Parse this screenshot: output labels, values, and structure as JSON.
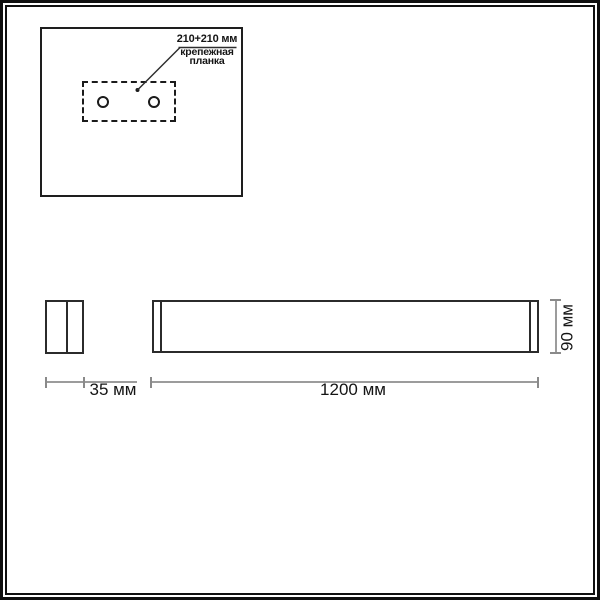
{
  "drawing": {
    "annotation": {
      "dimension_text": "210+210 мм",
      "label_line1": "крепежная",
      "label_line2": "планка"
    },
    "dimensions": {
      "side_width": "35 мм",
      "body_length": "1200 мм",
      "body_height": "90 мм"
    },
    "colors": {
      "line_black": "#1e1e1e",
      "dimension_line_gray": "#9c9c9c",
      "text": "#141414",
      "background": "#ffffff"
    }
  }
}
